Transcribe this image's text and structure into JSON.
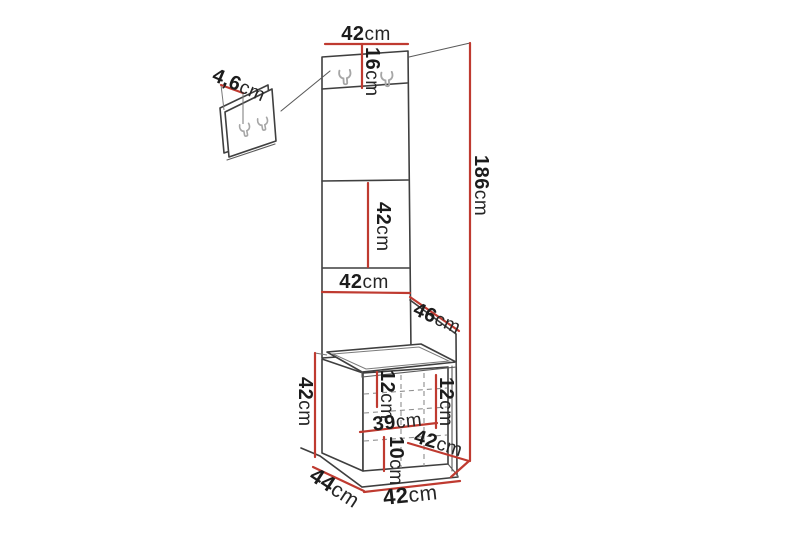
{
  "diagram": {
    "type": "furniture-dimension-drawing",
    "units": "cm",
    "colors": {
      "dimension_red": "#bf3a30",
      "outline_dark": "#3f3f3f",
      "hook_gray": "#a6a6a6",
      "text": "#1c1c1c",
      "background": "#ffffff"
    },
    "icons": {
      "wall_hook": "double-prong-wall-hook"
    },
    "dims": {
      "top_width": {
        "num": "42",
        "unit": "cm"
      },
      "hook_section_height": {
        "num": "16",
        "unit": "cm"
      },
      "hook_panel_thickness": {
        "num": "4,6",
        "unit": "cm"
      },
      "middle_panel_height": {
        "num": "42",
        "unit": "cm"
      },
      "panel_width": {
        "num": "42",
        "unit": "cm"
      },
      "side_panel_depth": {
        "num": "46",
        "unit": "cm"
      },
      "total_height": {
        "num": "186",
        "unit": "cm"
      },
      "bench_height": {
        "num": "42",
        "unit": "cm"
      },
      "bench_inner_left_height": {
        "num": "12",
        "unit": "cm"
      },
      "bench_inner_right_height": {
        "num": "12",
        "unit": "cm"
      },
      "bench_inner_width": {
        "num": "39",
        "unit": "cm"
      },
      "bench_base_height": {
        "num": "10",
        "unit": "cm"
      },
      "bench_top_depth": {
        "num": "42",
        "unit": "cm"
      },
      "bench_depth": {
        "num": "44",
        "unit": "cm"
      },
      "bench_width": {
        "num": "42",
        "unit": "cm"
      }
    }
  }
}
